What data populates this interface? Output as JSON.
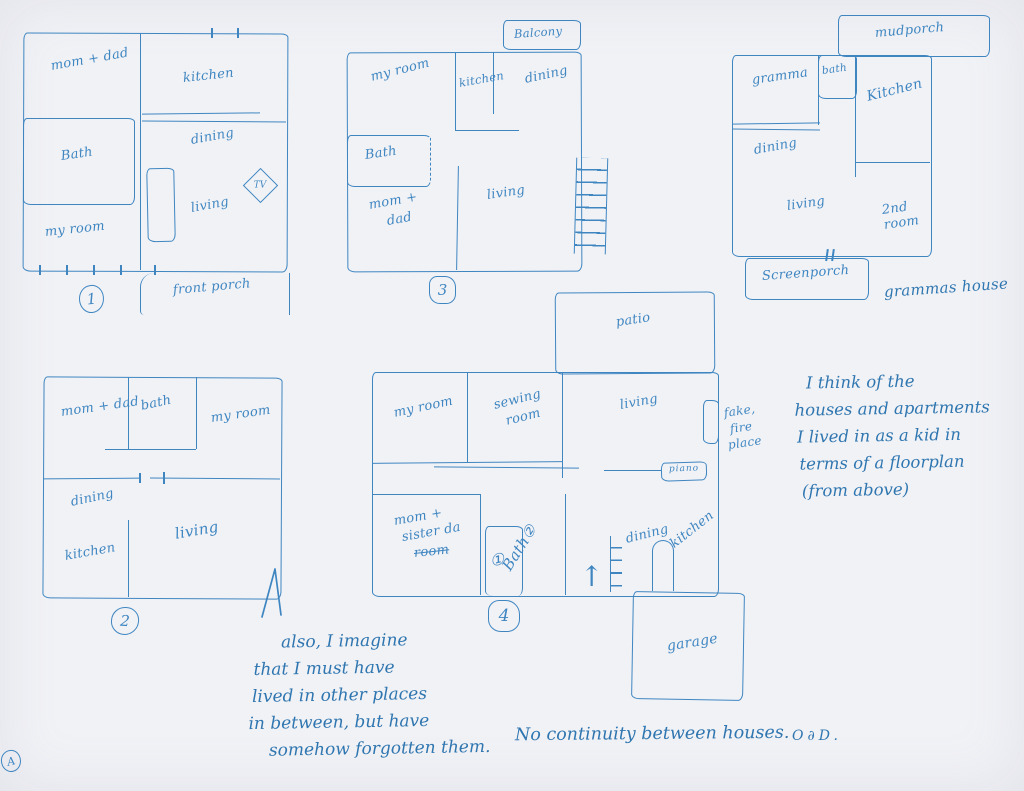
{
  "page": {
    "corner_mark": "A"
  },
  "plan1": {
    "number": "1",
    "rooms": {
      "parents": "mom + dad",
      "kitchen": "kitchen",
      "bath": "Bath",
      "dining": "dining",
      "living": "living",
      "my_room": "my room"
    },
    "tv": "TV",
    "porch": "front porch"
  },
  "plan2": {
    "number": "2",
    "rooms": {
      "parents": "mom + dad",
      "bath": "bath",
      "my_room": "my room",
      "dining": "dining",
      "kitchen": "kitchen",
      "living": "living"
    }
  },
  "plan3": {
    "number": "3",
    "balcony": "Balcony",
    "rooms": {
      "my_room": "my room",
      "kitchen": "kitchen",
      "dining": "dining",
      "bath": "Bath",
      "parents_line1": "mom +",
      "parents_line2": "dad",
      "living": "living"
    }
  },
  "plan4": {
    "number": "4",
    "patio": "patio",
    "rooms": {
      "my_room": "my room",
      "sewing_line1": "sewing",
      "sewing_line2": "room",
      "living": "living",
      "parents_line1": "mom +",
      "parents_line2": "sister da",
      "parents_line3": "room",
      "bath": "Bath②",
      "bath_door": "①",
      "dining": "dining",
      "kitchen": "kitchen"
    },
    "piano": "piano",
    "fireplace": [
      "fake,",
      "fire",
      "place"
    ],
    "garage": "garage",
    "entry_arrow": "↑"
  },
  "grammas": {
    "caption": "grammas house",
    "rooms": {
      "mudporch": "mudporch",
      "gramma": "gramma",
      "bath": "bath",
      "kitchen": "Kitchen",
      "dining": "dining",
      "living": "living",
      "second_line1": "2nd",
      "second_line2": "room",
      "screenporch": "Screenporch"
    }
  },
  "notes": {
    "right_note": [
      "I think of the",
      "houses and apartments",
      "I lived in as a kid in",
      "terms of a floorplan",
      "(from above)"
    ],
    "bottom_note": [
      "also, I imagine",
      "that I must have",
      "lived in other places",
      "in between, but have",
      "somehow forgotten them."
    ],
    "continuity": "No continuity between houses.",
    "initials": "O∂D."
  }
}
